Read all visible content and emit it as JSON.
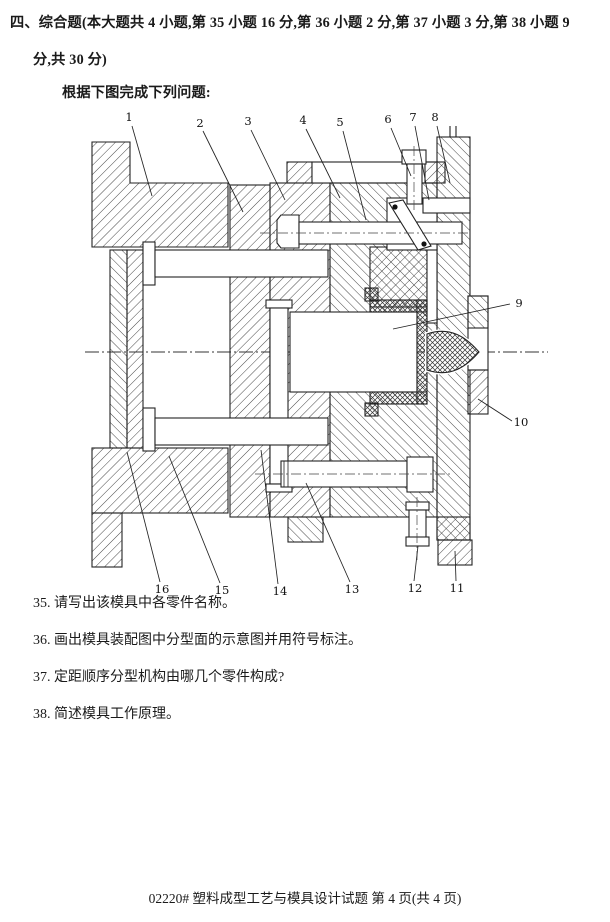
{
  "document": {
    "heading_line1": "四、综合题(本大题共 4 小题,第 35 小题 16 分,第 36 小题 2 分,第 37 小题 3 分,第 38 小题 9",
    "heading_line2": "分,共 30 分)",
    "intro": "根据下图完成下列问题:",
    "questions": [
      "35. 请写出该模具中各零件名称。",
      "36. 画出模具装配图中分型面的示意图并用符号标注。",
      "37. 定距顺序分型机构由哪几个零件构成?",
      "38. 简述模具工作原理。"
    ],
    "footer": "02220# 塑料成型工艺与模具设计试题 第 4 页(共 4 页)"
  },
  "figure": {
    "type": "injection-mold-assembly-cross-section",
    "ink_color": "#1f1f1f",
    "part_labels": [
      "1",
      "2",
      "3",
      "4",
      "5",
      "6",
      "7",
      "8",
      "9",
      "10",
      "11",
      "12",
      "13",
      "14",
      "15",
      "16"
    ]
  }
}
